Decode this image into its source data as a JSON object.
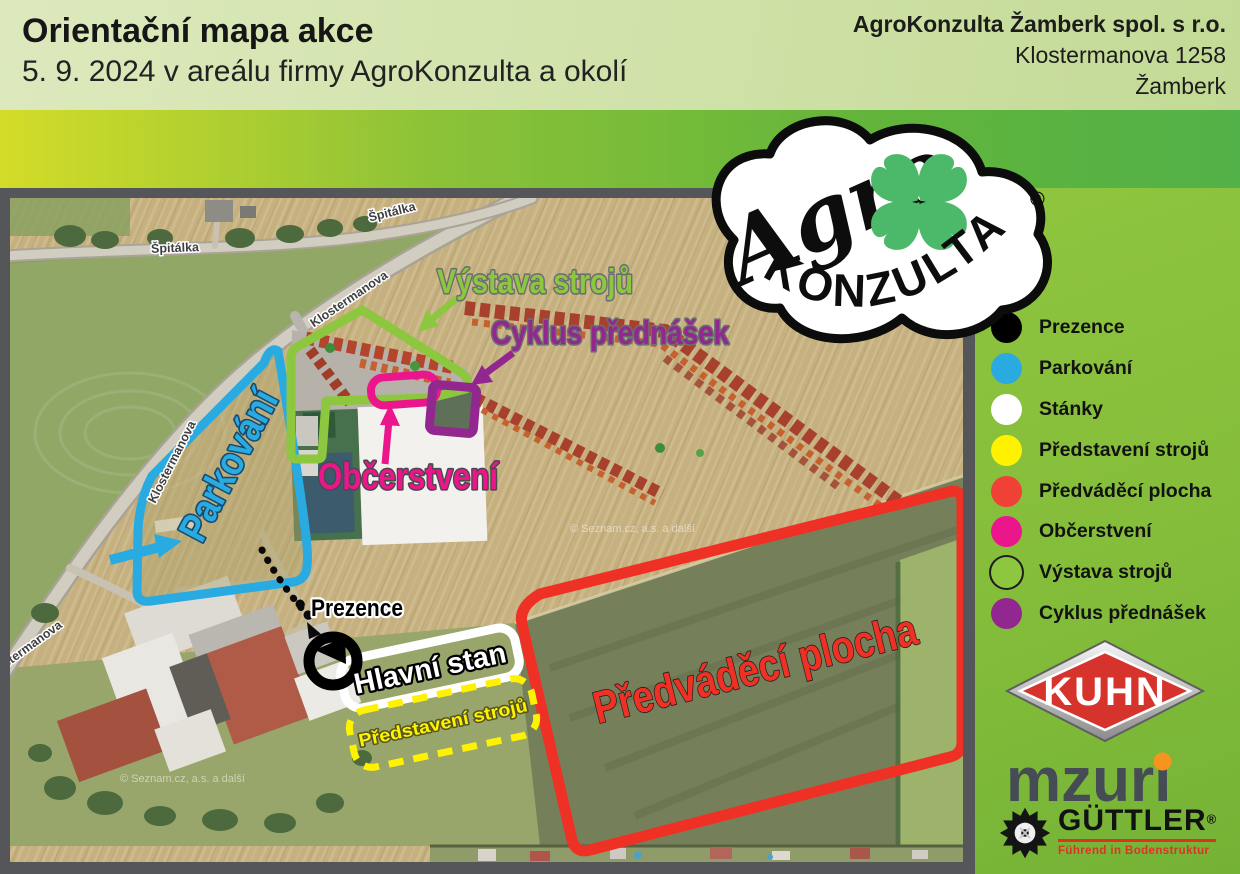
{
  "header": {
    "title": "Orientační mapa akce",
    "subtitle": "5. 9. 2024 v areálu firmy AgroKonzulta a okolí",
    "company_name": "AgroKonzulta Žamberk spol. s r.o.",
    "company_street": "Klostermanova 1258",
    "company_city": "Žamberk"
  },
  "legend": {
    "items": [
      {
        "label": "Prezence",
        "color": "#000000"
      },
      {
        "label": "Parkování",
        "color": "#29ABE2"
      },
      {
        "label": "Stánky",
        "color": "#FFFFFF"
      },
      {
        "label": "Představení strojů",
        "color": "#FFF200"
      },
      {
        "label": "Předváděcí plocha",
        "color": "#EF4136"
      },
      {
        "label": "Občerstvení",
        "color": "#EC168C"
      },
      {
        "label": "Výstava strojů",
        "color": "#8DC63F"
      },
      {
        "label": "Cyklus přednášek",
        "color": "#92278F"
      }
    ]
  },
  "map": {
    "street_labels": {
      "spitalka": "Špitálka",
      "klostermanova": "Klostermanova"
    },
    "watermark": "© Seznam.cz, a.s. a další",
    "annotations": {
      "parkovani": {
        "label": "Parkování",
        "color": "#29ABE2"
      },
      "vystava": {
        "label": "Výstava strojů",
        "color": "#8DC63F"
      },
      "cyklus": {
        "label": "Cyklus přednášek",
        "color": "#92278F"
      },
      "obcerstveni": {
        "label": "Občerstvení",
        "color": "#EC168C"
      },
      "prezence": {
        "label": "Prezence",
        "color": "#000000"
      },
      "hlavni_stan": {
        "label": "Hlavní stan",
        "color": "#FFFFFF"
      },
      "predstaveni": {
        "label": "Představení strojů",
        "color": "#FFF200"
      },
      "predvadeci": {
        "label": "Předváděcí plocha",
        "color": "#EE3124"
      }
    }
  },
  "logos": {
    "agrokonzulta": {
      "script": "Agro",
      "arc": "KONZULTA",
      "reg": "®"
    },
    "kuhn": {
      "text": "KUHN"
    },
    "mzuri": {
      "text": "mzuri"
    },
    "guttler": {
      "text": "GÜTTLER",
      "reg": "®",
      "tagline": "Führend in Bodenstruktur"
    }
  }
}
